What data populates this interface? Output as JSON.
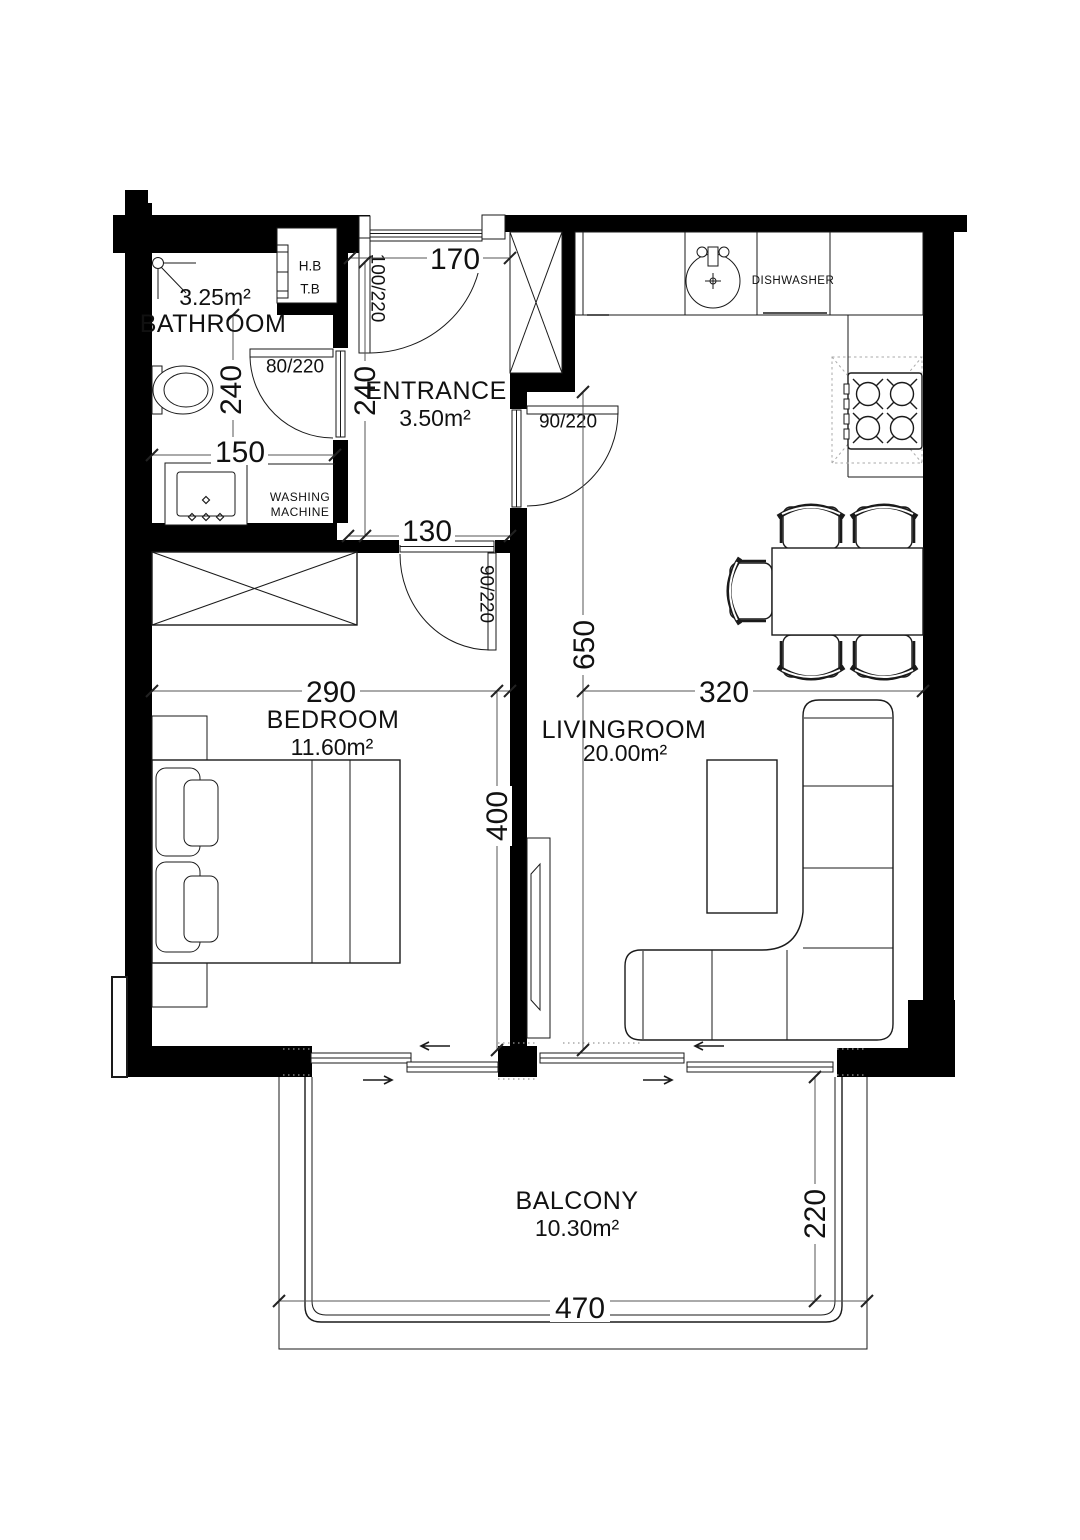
{
  "drawing": {
    "rooms": {
      "bathroom": {
        "name": "BATHROOM",
        "area": "3.25m²"
      },
      "entrance": {
        "name": "ENTRANCE",
        "area": "3.50m²"
      },
      "bedroom": {
        "name": "BEDROOM",
        "area": "11.60m²"
      },
      "livingroom": {
        "name": "LIVINGROOM",
        "area": "20.00m²"
      },
      "balcony": {
        "name": "BALCONY",
        "area": "10.30m²"
      }
    },
    "labels": {
      "dishwasher": "DISHWASHER",
      "washing_line1": "WASHING",
      "washing_line2": "MACHINE",
      "shaft_line1": "H.B",
      "shaft_line2": "T.B"
    },
    "dimensions": {
      "entrance_width": "170",
      "bathroom_depth": "240",
      "entrance_depth": "240",
      "bathroom_width": "150",
      "entrance_hall_width": "130",
      "bedroom_width": "290",
      "livingroom_width": "320",
      "livingroom_depth": "650",
      "bedroom_depth": "400",
      "balcony_width": "470",
      "balcony_depth": "220"
    },
    "doors": {
      "entrance": "100/220",
      "bathroom": "80/220",
      "livingroom": "90/220",
      "bedroom": "90/220"
    },
    "colors": {
      "wall": "#000000",
      "line": "#1a1a1a",
      "dim_line": "#555555",
      "background": "#ffffff"
    }
  }
}
